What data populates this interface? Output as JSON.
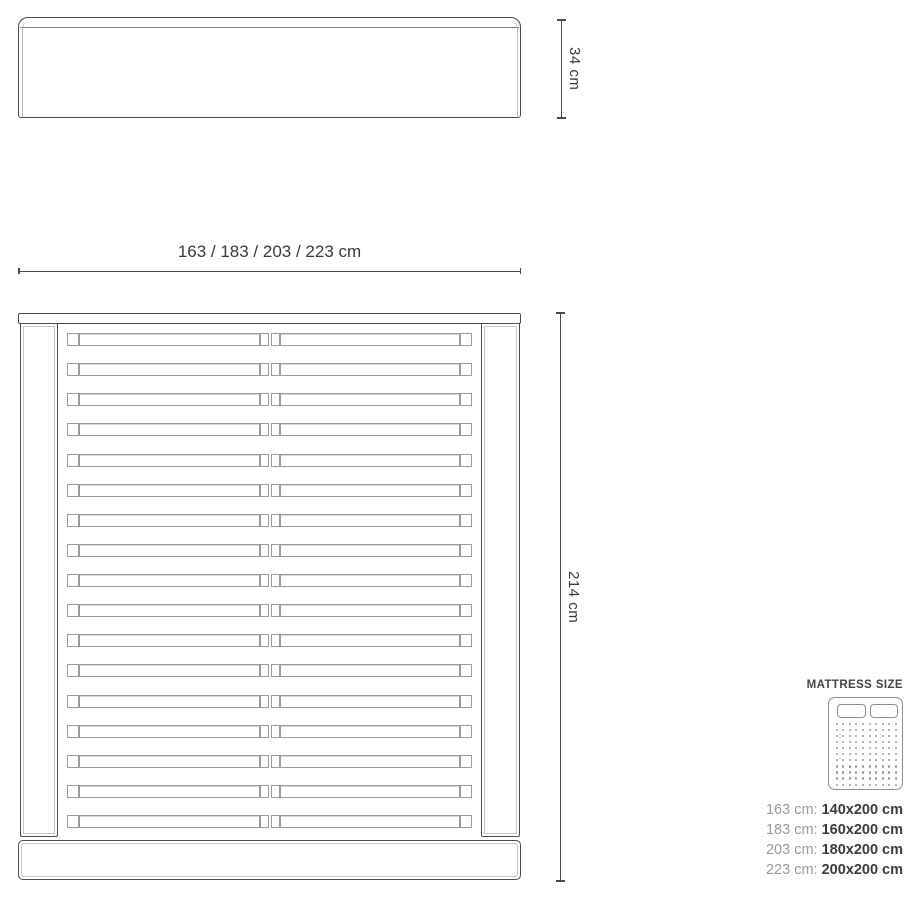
{
  "drawing": {
    "front_view": {
      "height_label": "34 cm"
    },
    "top_view": {
      "width_label": "163 / 183 / 203 / 223 cm",
      "length_label": "214 cm",
      "slat_rows": 17
    }
  },
  "mattress_panel": {
    "title": "MATTRESS SIZE",
    "icon": {
      "name": "double-mattress-icon",
      "pillows": 2,
      "dot_cols": 10,
      "dot_rows": 11
    },
    "sizes": [
      {
        "frame": "163 cm:",
        "mattress": "140x200 cm"
      },
      {
        "frame": "183 cm:",
        "mattress": "160x200 cm"
      },
      {
        "frame": "203 cm:",
        "mattress": "180x200 cm"
      },
      {
        "frame": "223 cm:",
        "mattress": "200x200 cm"
      }
    ]
  },
  "colors": {
    "background": "#ffffff",
    "line_dark": "#4a4a4a",
    "line_light": "#9b9b9b",
    "text_dark": "#3a3a3a",
    "text_gray": "#9a9a9a"
  }
}
